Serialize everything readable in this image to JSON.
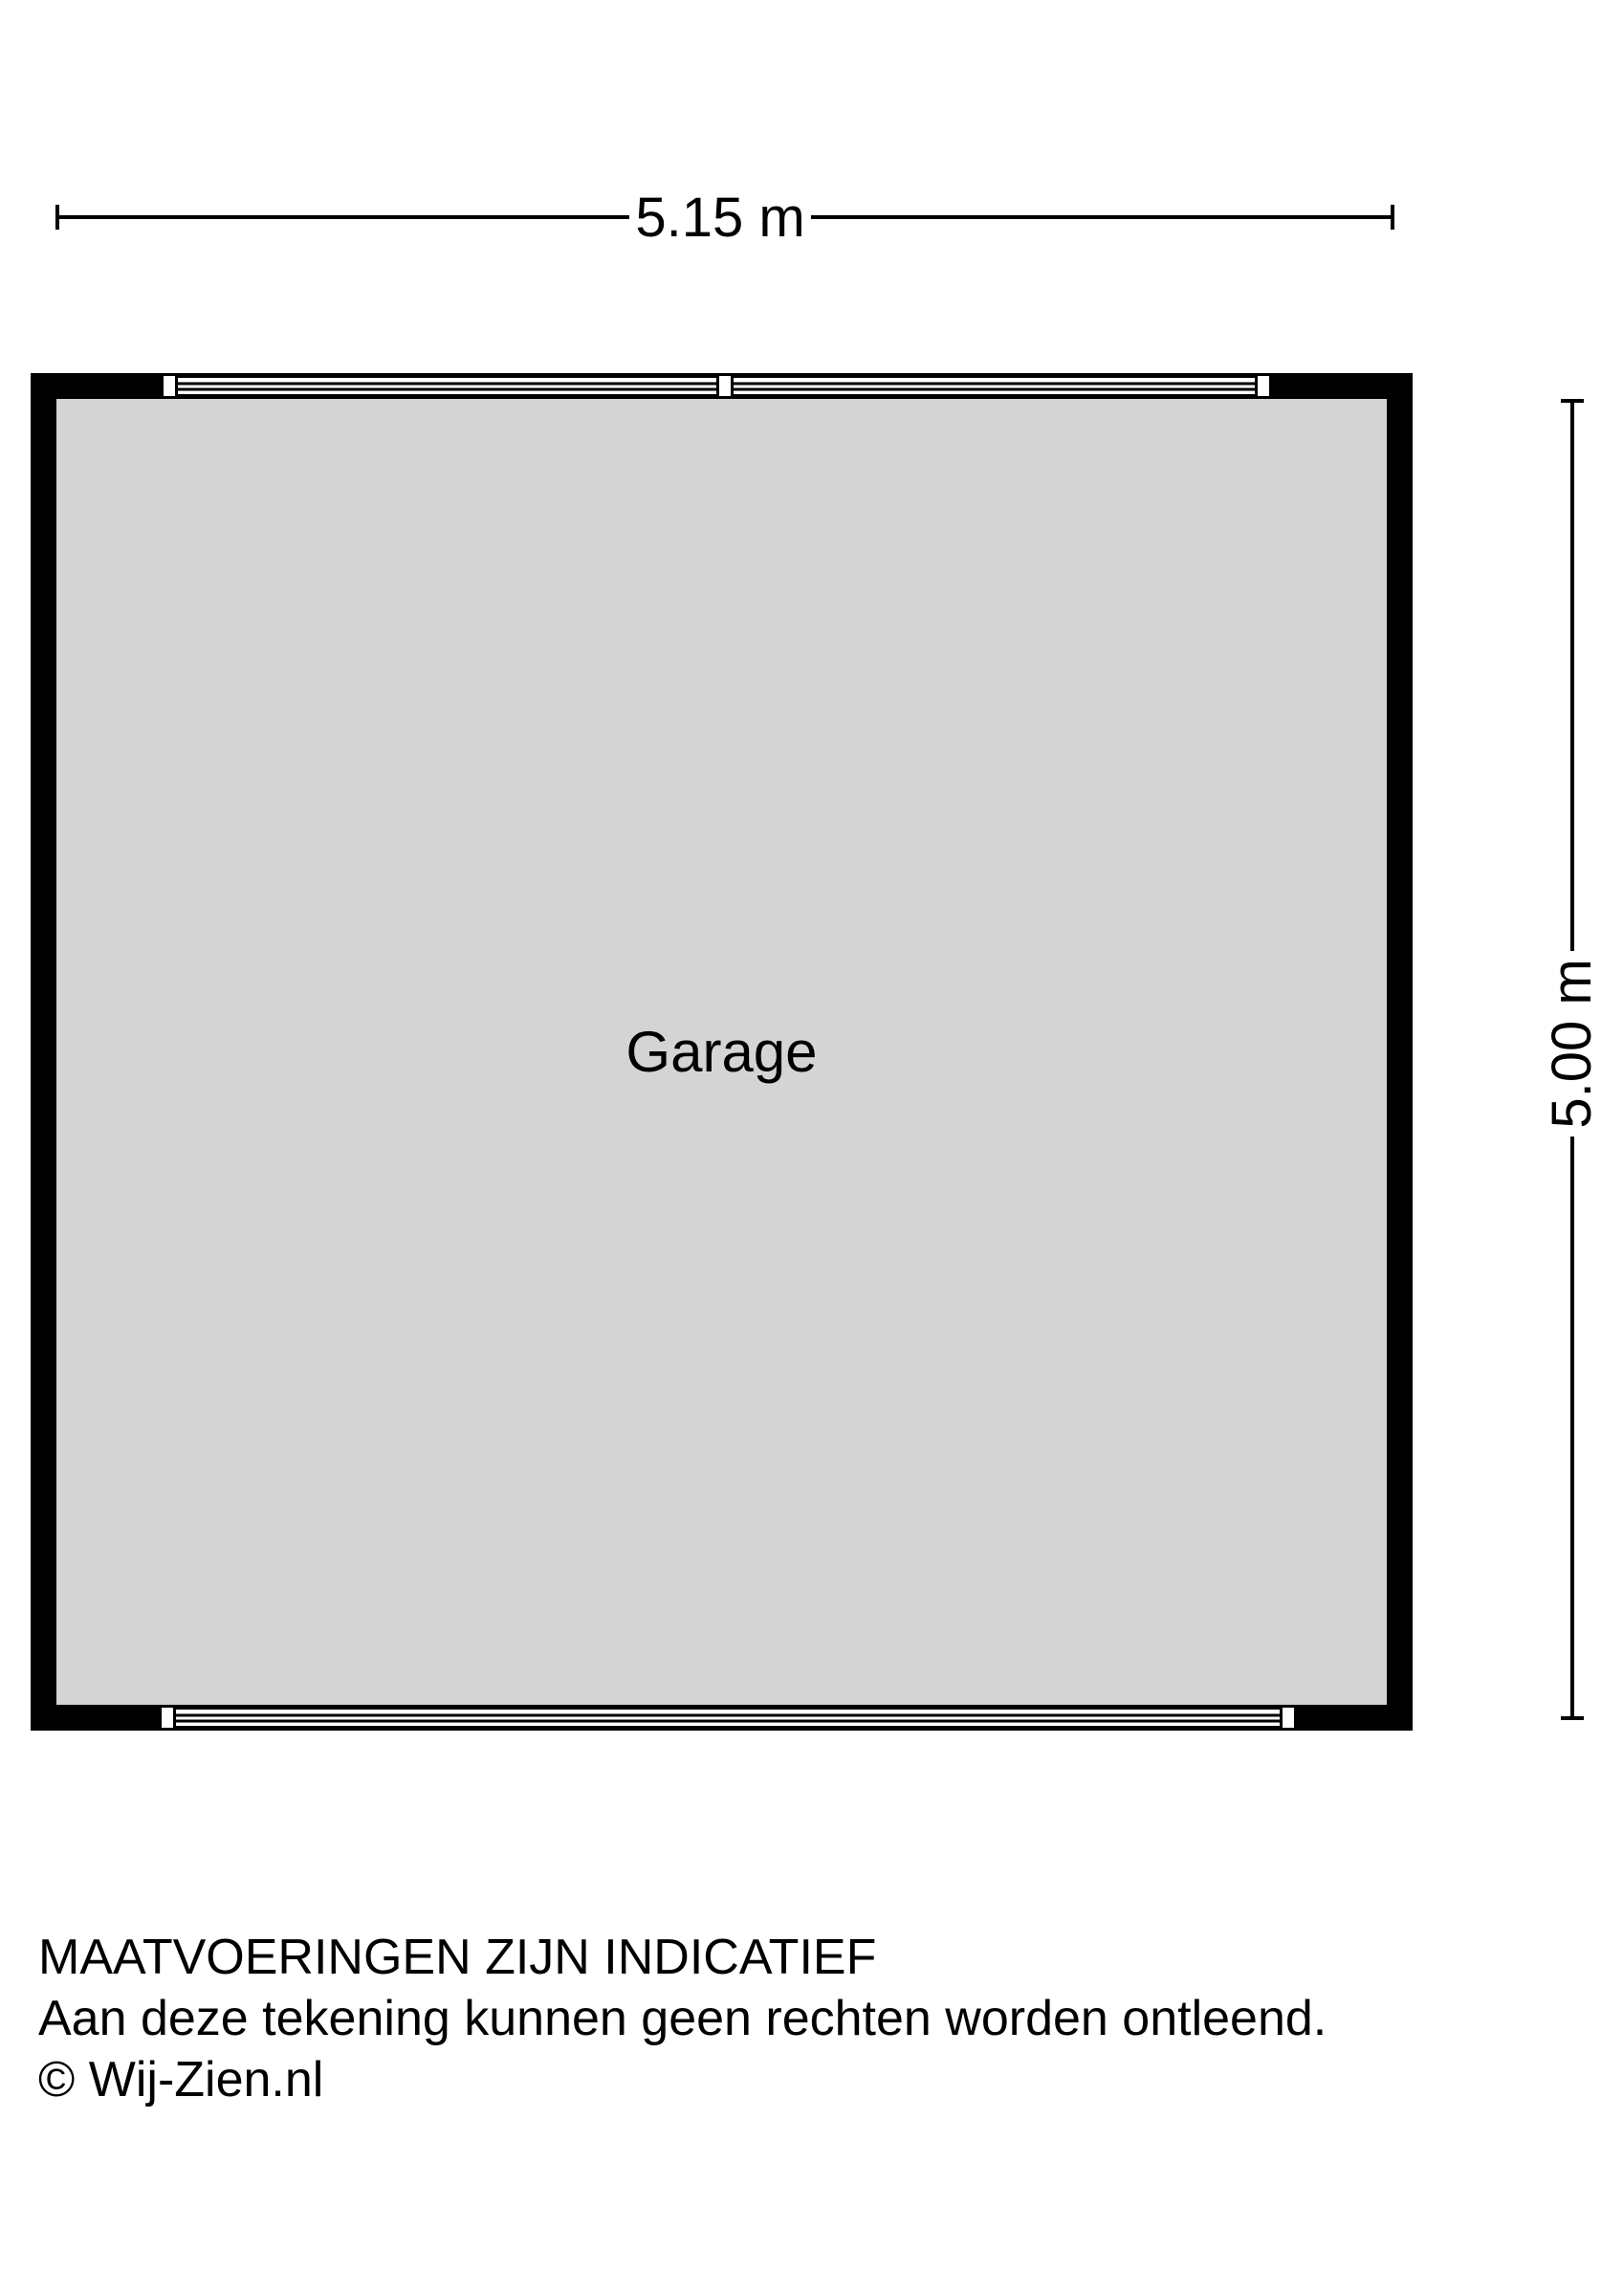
{
  "dimensions": {
    "width_label": "5.15 m",
    "height_label": "5.00 m"
  },
  "room": {
    "label": "Garage"
  },
  "footer": {
    "line1": "MAATVOERINGEN ZIJN INDICATIEF",
    "line2": "Aan deze tekening kunnen geen rechten worden ontleend.",
    "line3": "© Wij-Zien.nl"
  },
  "colors": {
    "wall": "#000000",
    "floor": "#d4d4d4",
    "background": "#ffffff",
    "dimension-line": "#000000",
    "text": "#000000"
  }
}
